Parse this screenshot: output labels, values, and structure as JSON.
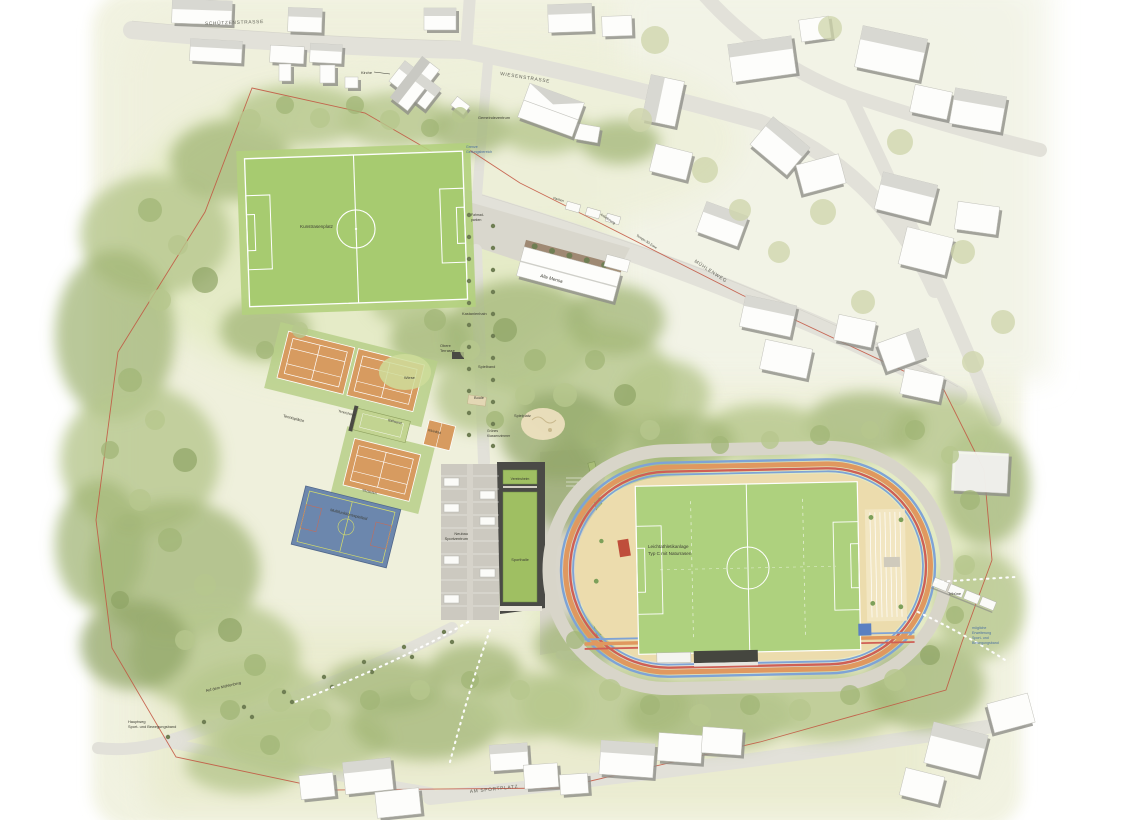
{
  "title": "Lageplan Sportpark",
  "streets": {
    "schuetzenstrasse": "SCHÜTZENSTRASSE",
    "wiesenstrasse": "WIESENSTRASSE",
    "muehlenweg": "MÜHLENWEG",
    "am_sportplatz": "AM SPORTPLATZ",
    "tempo_zone": "Tempo-30-Zone",
    "auf_dem_muehlenberg": "Auf dem Mühlenberg"
  },
  "buildings": {
    "kirche": "Kirche",
    "gemeindezentrum": "Gemeindezentrum",
    "alte_mensa": "Alte Mensa",
    "vereinsheim": "Vereinsheim",
    "sporthalle": "Sporthalle",
    "neubau_line1": "Neubau",
    "neubau_line2": "Sportzentrum",
    "tennisheim": "Tennisheim"
  },
  "sports": {
    "kunstrasenplatz": "Kunstrasenplatz",
    "tennisplaetze": "Tennisplätze",
    "ballwand": "Ballwand",
    "kleinfeld": "Kleinfeld",
    "multifunktionsspielfeld": "Multifunktionsspielfeld",
    "sitzstufen": "Sitzstufen",
    "leichtathletik_line1": "Leichtathletikanlage",
    "leichtathletik_line2": "Typ C mit Naturrasen",
    "tribuene": "Tribüne",
    "fahrradparken_line1": "Fahrrad-",
    "fahrradparken_line2": "parken"
  },
  "park": {
    "kastanienhain": "Kastanienhain",
    "obere_terrasse_line1": "Obere",
    "obere_terrasse_line2": "Terrasse",
    "wiese": "Wiese",
    "spielband": "Spielband",
    "boule": "Boule",
    "spielplatz": "Spielplatz",
    "klassenzimmer_line1": "Grünes",
    "klassenzimmer_line2": "Klassenzimmer",
    "parken": "Parken",
    "anlieferung": "Anlieferung",
    "hauptweg_line1": "Hauptweg",
    "hauptweg_line2": "Sport- und Bewegungsband"
  },
  "annotations": {
    "grenze_line1": "Grenze",
    "grenze_line2": "Geltungsbereich",
    "erweiterung_line1": "mögliche",
    "erweiterung_line2": "Erweiterung",
    "erweiterung_line3": "Sport- und",
    "erweiterung_line4": "Bewegungsband"
  },
  "palette": {
    "pitch_green": "#a7cb70",
    "infield_green": "#aed17e",
    "track_tan": "#ecdcad",
    "lane_blue": "#7ea3d6",
    "lane_orange": "#e0985f",
    "lane_red": "#cf5f55",
    "tennis_clay": "#d79b60",
    "court_blue": "#6c87ad",
    "court_blue_lines": "#d6de6a",
    "boundary_red": "#c2523e",
    "forest_green": "#aabc82",
    "road_grey": "#e2e1d9",
    "roof_green": "#9fbf62"
  }
}
